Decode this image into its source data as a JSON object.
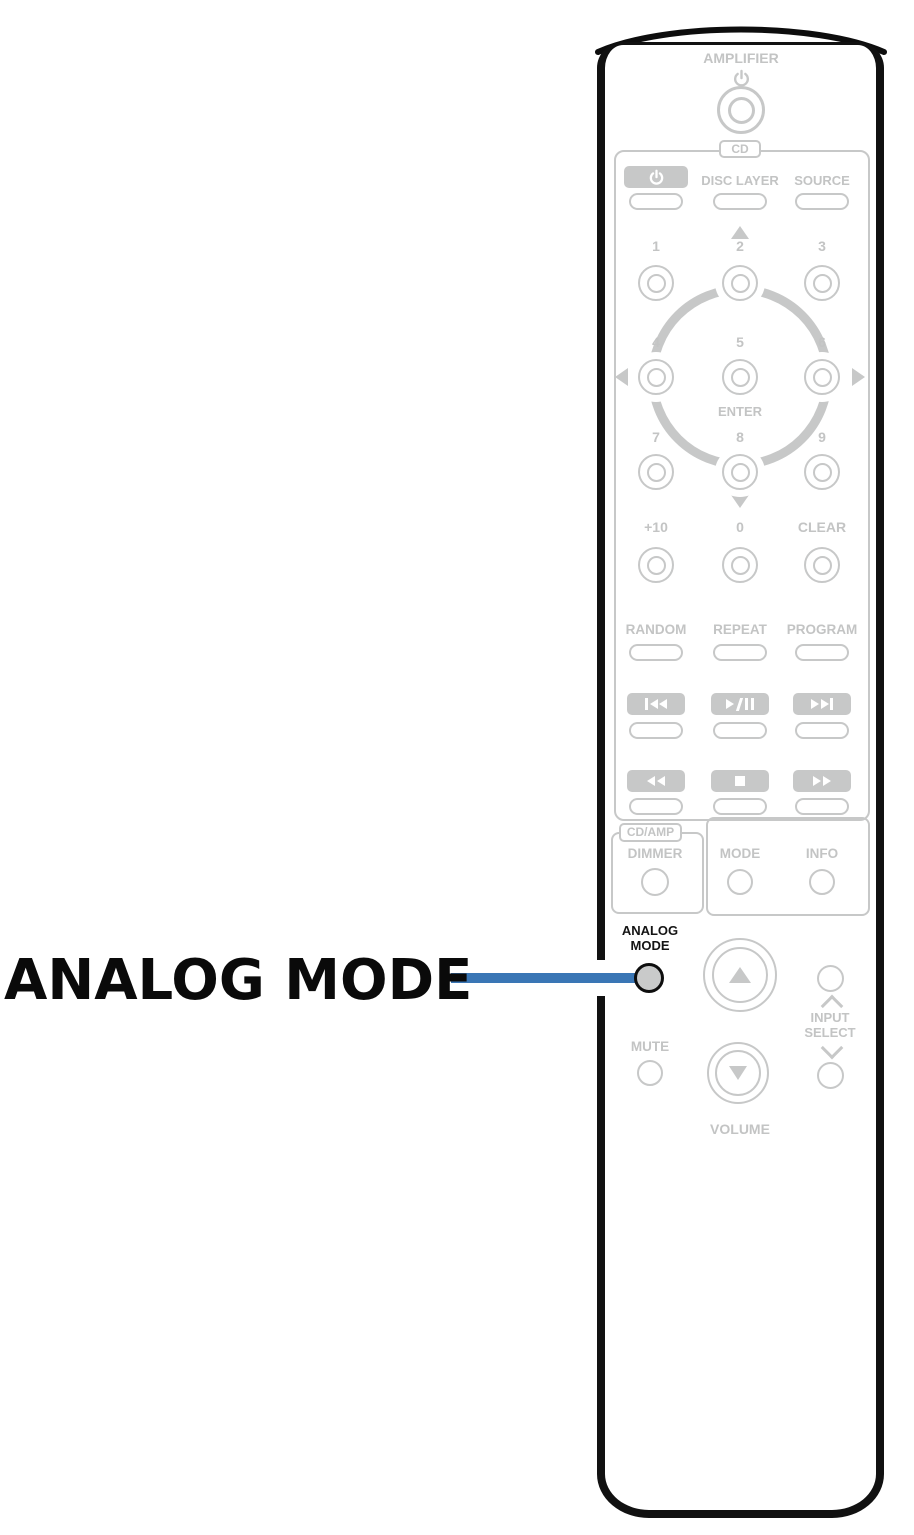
{
  "callout": {
    "label": "ANALOG MODE"
  },
  "colors": {
    "accent_blue": "#3A76B5",
    "inactive_gray": "#C7C8C8",
    "outline_black": "#111111"
  },
  "remote": {
    "amplifier": {
      "label": "AMPLIFIER"
    },
    "cd": {
      "tag": "CD",
      "disc_layer": "DISC LAYER",
      "source": "SOURCE",
      "digits": [
        "1",
        "2",
        "3",
        "4",
        "5",
        "6",
        "7",
        "8",
        "9"
      ],
      "enter": "ENTER",
      "plus10": "+10",
      "zero": "0",
      "clear": "CLEAR",
      "random": "RANDOM",
      "repeat": "REPEAT",
      "program": "PROGRAM"
    },
    "panel": {
      "cd_amp_tag": "CD/AMP",
      "dimmer": "DIMMER",
      "mode": "MODE",
      "info": "INFO"
    },
    "bottom": {
      "analog_line1": "ANALOG",
      "analog_line2": "MODE",
      "mute": "MUTE",
      "input": "INPUT",
      "select": "SELECT",
      "volume": "VOLUME"
    }
  }
}
